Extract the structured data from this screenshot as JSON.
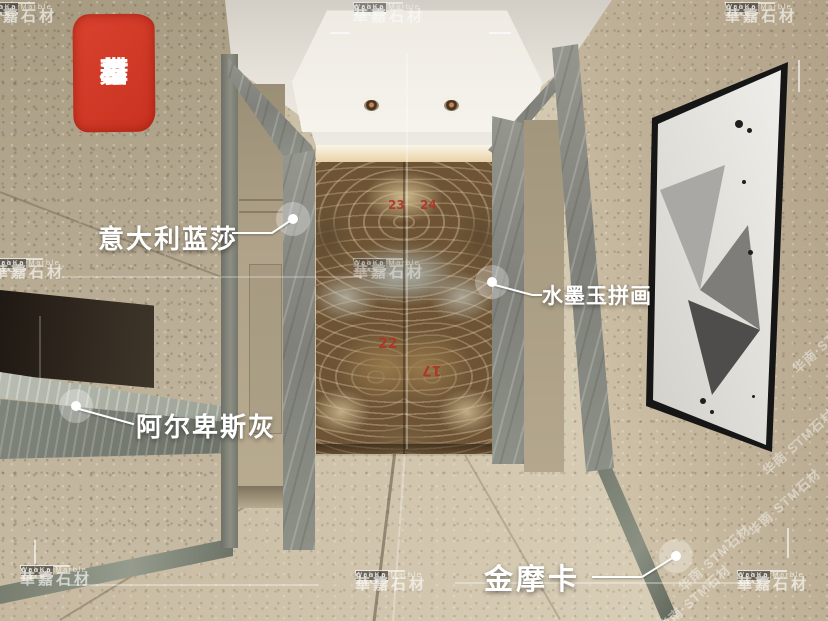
{
  "watermark": {
    "hj": "H&J",
    "group": "Group",
    "cn": "華嘉石材",
    "en": "WahKa Marble"
  },
  "seal": {
    "chars": [
      "石",
      "華",
      "材",
      "嘉"
    ],
    "color": "#d03928"
  },
  "labels": [
    {
      "id": "italian-lansha",
      "text": "意大利蓝莎"
    },
    {
      "id": "ink-jade-mosaic",
      "text": "水墨玉拼画"
    },
    {
      "id": "alpine-gray",
      "text": "阿尔卑斯灰"
    },
    {
      "id": "gold-mocha",
      "text": "金摩卡"
    }
  ],
  "slab_numbers": [
    "23",
    "24",
    "22",
    "17"
  ],
  "diagonal_watermark": "华南·STM石材",
  "colors": {
    "label_text": "#ffffff",
    "seal_red": "#d03928",
    "slab_number_red": "#ad3528",
    "wall_beige": "#b7aa90",
    "marble_gray": "#8e9088",
    "onyx_brown": "#6e5435",
    "floor_beige": "#d2c6ae"
  }
}
